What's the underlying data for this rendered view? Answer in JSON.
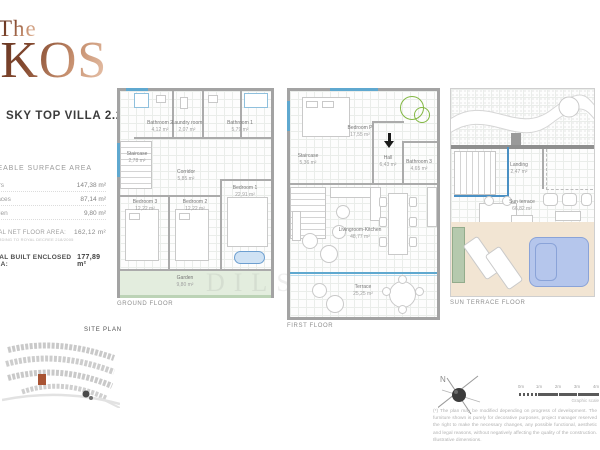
{
  "logo": {
    "line1": "The",
    "line2": "IKOS"
  },
  "header": {
    "title": "SKY TOP VILLA 2.2"
  },
  "areas": {
    "section_title": "USEABLE SURFACE AREA",
    "rows": [
      {
        "label": "Floors",
        "value": "147,38 m²"
      },
      {
        "label": "Terraces",
        "value": "87,14 m²"
      },
      {
        "label": "Garden",
        "value": "9,80 m²"
      }
    ],
    "total_net": {
      "label": "TOTAL NET FLOOR AREA:",
      "value": "162,12 m²",
      "note": "ACCORDING TO ROYAL DECREE 218/2005"
    },
    "total_built": {
      "label": "TOTAL BUILT ENCLOSED AREA:",
      "value": "177,89 m²"
    }
  },
  "floors": [
    {
      "caption": "GROUND FLOOR",
      "rooms": [
        {
          "name": "Bathroom 2",
          "area": "4,12 m²"
        },
        {
          "name": "Laundry room",
          "area": "2,07 m²"
        },
        {
          "name": "Bathroom 1",
          "area": "5,79 m²"
        },
        {
          "name": "Staircase",
          "area": "2,78 m²"
        },
        {
          "name": "Corridor",
          "area": "5,85 m²"
        },
        {
          "name": "Bedroom 3",
          "area": "12,22 m²"
        },
        {
          "name": "Bedroom 2",
          "area": "12,22 m²"
        },
        {
          "name": "Bedroom 1",
          "area": "22,91 m²"
        },
        {
          "name": "Garden",
          "area": "9,80 m²"
        }
      ]
    },
    {
      "caption": "FIRST FLOOR",
      "rooms": [
        {
          "name": "Bedroom P",
          "area": "17,55 m²"
        },
        {
          "name": "Staircase",
          "area": "5,36 m²"
        },
        {
          "name": "Hall",
          "area": "6,43 m²"
        },
        {
          "name": "Bathroom 3",
          "area": "4,65 m²"
        },
        {
          "name": "Livingroom-Kitchen",
          "area": "48,77 m²"
        },
        {
          "name": "Terrace",
          "area": "25,25 m²"
        }
      ]
    },
    {
      "caption": "SUN TERRACE FLOOR",
      "rooms": [
        {
          "name": "Landing",
          "area": "2,47 m²"
        },
        {
          "name": "Sun terrace",
          "area": "66,82 m²"
        }
      ]
    }
  ],
  "site_plan": {
    "label": "SITE PLAN"
  },
  "compass": {
    "label": "N"
  },
  "scale": {
    "ticks": [
      "0m",
      "1m",
      "2m",
      "3m",
      "4m"
    ],
    "caption": "Graphic scale"
  },
  "watermark": "DILS",
  "disclaimer": "(*) The plan may be modified depending on progress of development. The furniture shown is purely for decorative purposes, project manager reserved the right to make the necessary changes, any possible functional, aesthetic and legal reasons, without negatively affecting the quality of the construction. Illustrative dimensions.",
  "colors": {
    "accent_blue": "#5fa8cf",
    "accent_green": "#82b742",
    "garden_fill": "#e3edde",
    "deck_fill": "#f2e5d3",
    "pool_fill": "#b5c6ec",
    "logo_copper": "#8a4c32",
    "highlight_unit": "#a85434"
  }
}
